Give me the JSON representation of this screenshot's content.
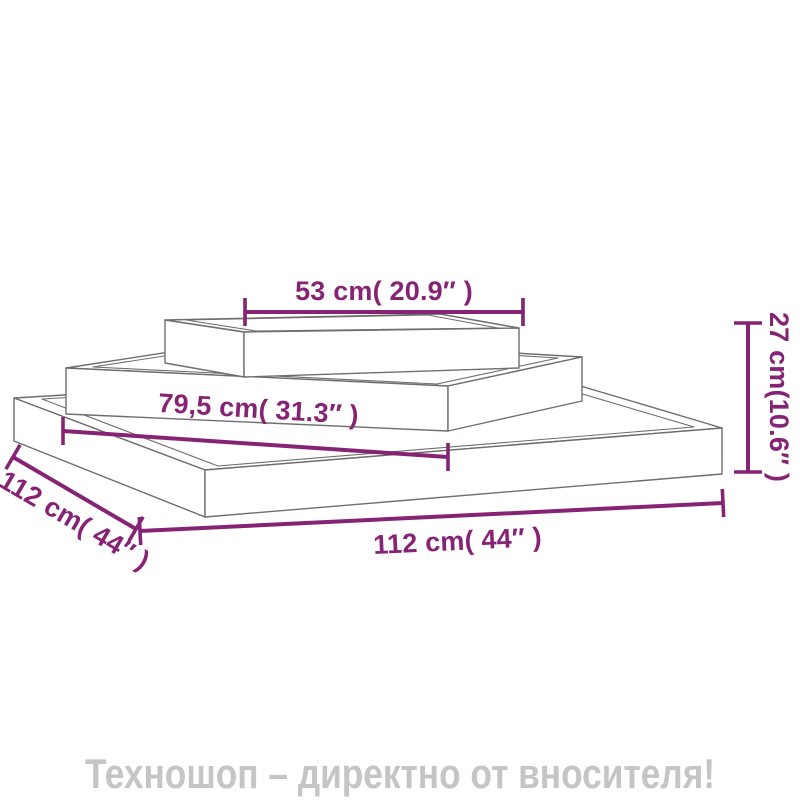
{
  "diagram": {
    "accent_color": "#862375",
    "sketch_color": "#6e6e6e",
    "dimensions": {
      "top_width": "53 cm( 20.9″ )",
      "middle_width": "79,5 cm( 31.3″ )",
      "left_depth": "112 cm( 44″ )",
      "bottom_width": "112 cm( 44″ )",
      "right_height": "27 cm(10.6″ )"
    }
  },
  "footer": {
    "text": "Техношоп – директно от вносителя!",
    "color": "#c5c5c5"
  }
}
